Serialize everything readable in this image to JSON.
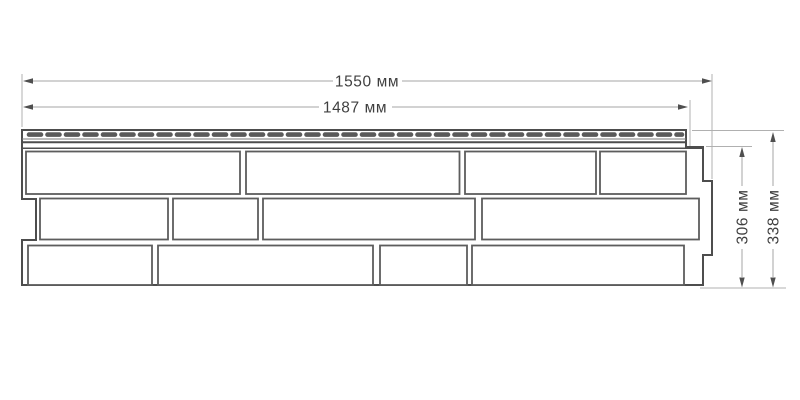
{
  "diagram": {
    "type": "facade-panel-dimension-drawing",
    "labels": {
      "width_total": "1550 мм",
      "width_nominal": "1487 мм",
      "height_nominal": "306 мм",
      "height_total": "338 мм"
    },
    "values": {
      "width_total_mm": 1550,
      "width_nominal_mm": 1487,
      "height_nominal_mm": 306,
      "height_total_mm": 338,
      "unit": "мм"
    },
    "panel": {
      "rows_of_bricks": 3,
      "bricks_per_row": [
        4,
        4,
        4
      ],
      "has_perforated_nail_hem": true
    },
    "colors": {
      "background": "#ffffff",
      "outline": "#4d4d4d",
      "brick_border": "#5d5d5d",
      "perforation": "#5a5a5a",
      "dimension_line": "#a6a6a6",
      "arrow": "#4f4f4f",
      "text": "#3f3f3f"
    }
  }
}
